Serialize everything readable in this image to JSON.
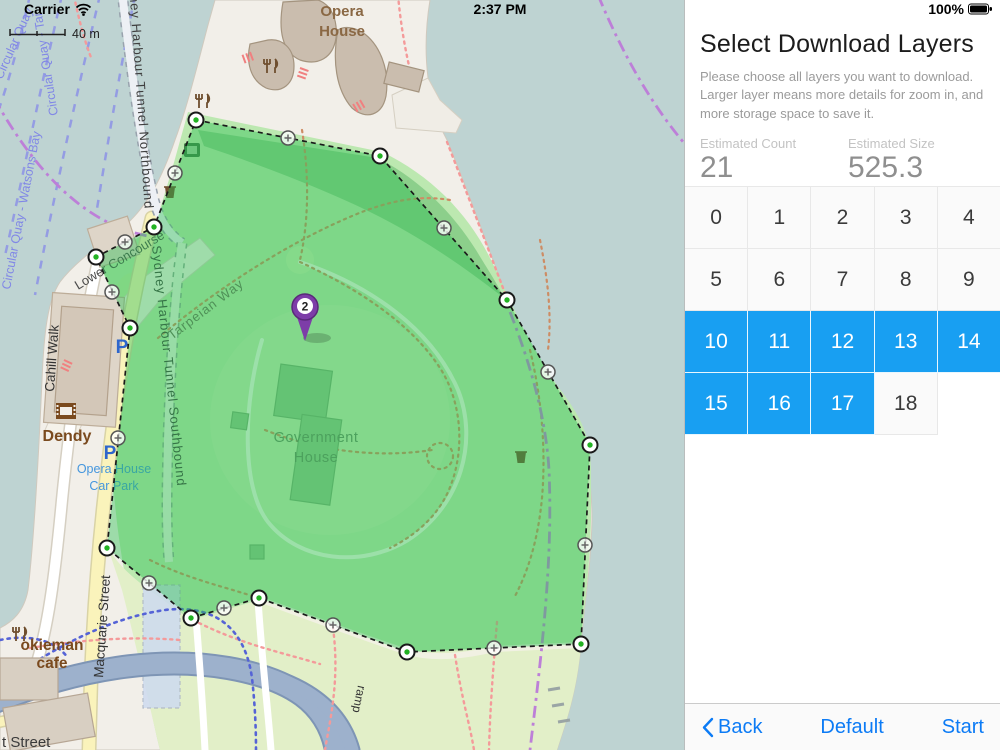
{
  "status_bar": {
    "carrier": "Carrier",
    "time": "2:37 PM",
    "battery": "100%"
  },
  "map": {
    "scale_label": "40 m",
    "marker_label": "2",
    "labels": {
      "opera_house_1": "Opera",
      "opera_house_2": "House",
      "government_house_1": "Government",
      "government_house_2": "House",
      "tarpeian_way": "Tarpeian Way",
      "lower_concourse": "Lower Concourse",
      "cahill_walk": "Cahill Walk",
      "tunnel_northbound": "Sydney Harbour Tunnel Northbound",
      "tunnel_southbound": "Sydney Harbour Tunnel Southbound",
      "macquarie_street": "Macquarie Street",
      "t_street": "t Street",
      "ramp": "ramp",
      "dendy": "Dendy",
      "okieman_1": "okieman",
      "okieman_2": "cafe",
      "car_park_1": "Opera House",
      "car_park_2": "Car Park",
      "parking": "P",
      "ferry_watsons": "Circular Quay - Watsons Bay",
      "ferry_circular": "Circular Quay",
      "ferry_tar": "Circular Quay - Tar"
    }
  },
  "panel": {
    "title": "Select Download Layers",
    "description": "Please choose all layers you want to download. Larger layer means more details for zoom in, and more storage space to save it.",
    "estimated_count": {
      "label": "Estimated Count",
      "value": "21",
      "unit": "image(s)"
    },
    "estimated_size": {
      "label": "Estimated Size",
      "value": "525.3",
      "unit": "KB"
    },
    "accent_color": "#189ff2",
    "layers": [
      {
        "label": "0",
        "selected": false
      },
      {
        "label": "1",
        "selected": false
      },
      {
        "label": "2",
        "selected": false
      },
      {
        "label": "3",
        "selected": false
      },
      {
        "label": "4",
        "selected": false
      },
      {
        "label": "5",
        "selected": false
      },
      {
        "label": "6",
        "selected": false
      },
      {
        "label": "7",
        "selected": false
      },
      {
        "label": "8",
        "selected": false
      },
      {
        "label": "9",
        "selected": false
      },
      {
        "label": "10",
        "selected": true
      },
      {
        "label": "11",
        "selected": true
      },
      {
        "label": "12",
        "selected": true
      },
      {
        "label": "13",
        "selected": true
      },
      {
        "label": "14",
        "selected": true
      },
      {
        "label": "15",
        "selected": true
      },
      {
        "label": "16",
        "selected": true
      },
      {
        "label": "17",
        "selected": true
      },
      {
        "label": "18",
        "selected": false
      }
    ],
    "toolbar": {
      "back": "Back",
      "default": "Default",
      "start": "Start"
    }
  }
}
